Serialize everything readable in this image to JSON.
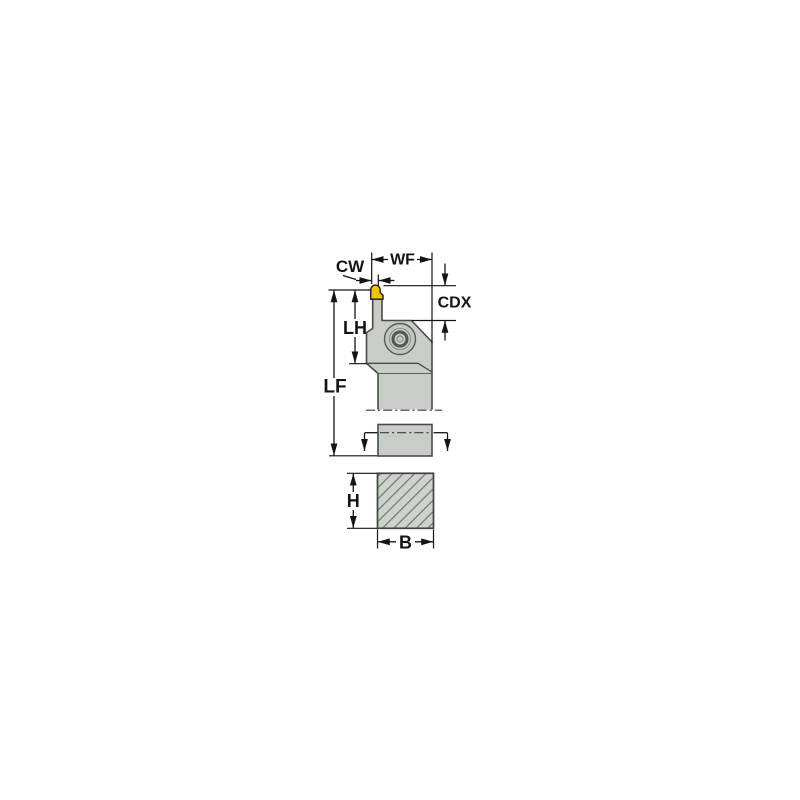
{
  "drawing": {
    "title": "toolholder-dimension-drawing",
    "view": "front view of grooving toolholder with shank cross-section",
    "labels": {
      "wf": "WF",
      "cw": "CW",
      "cdx": "CDX",
      "lh": "LH",
      "lf": "LF",
      "h": "H",
      "b": "B"
    },
    "colors": {
      "insert_yellow": "#f0c400",
      "body_gray": "#c8cdc8",
      "section_gray": "#cdd2cd",
      "outline_gray": "#474c47",
      "hatch_gray": "#6d726d",
      "dimension_black": "#141414",
      "background": "#ffffff"
    }
  }
}
